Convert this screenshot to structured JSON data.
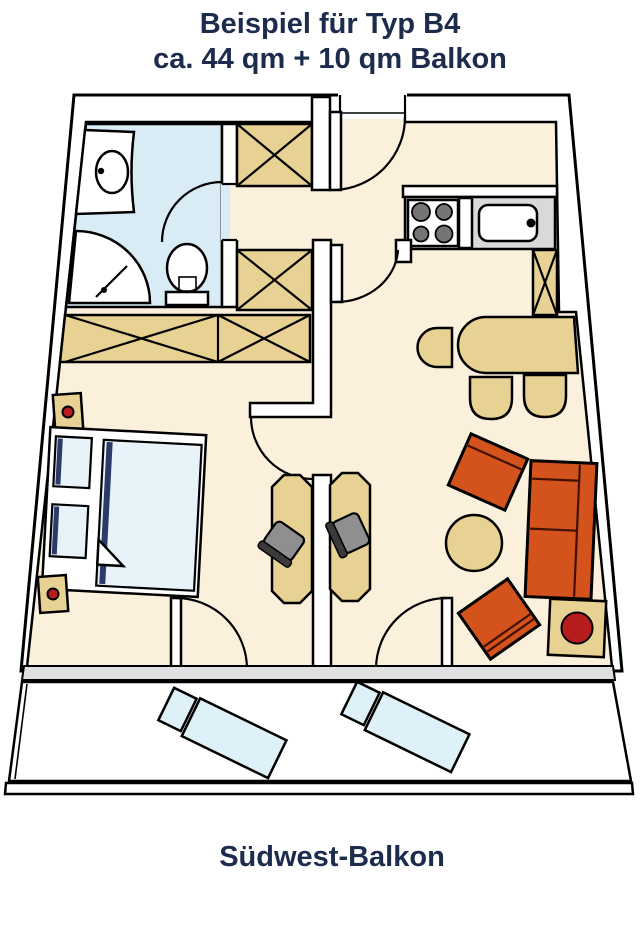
{
  "title": {
    "line1": "Beispiel für Typ B4",
    "line2": "ca. 44 qm + 10 qm Balkon"
  },
  "footer": {
    "balcony_label": "Südwest-Balkon"
  },
  "colors": {
    "background": "#ffffff",
    "wall": "#ffffff",
    "outline": "#000000",
    "floor": "#fbf0dc",
    "bathroom_floor": "#d9ecf5",
    "wood": "#e7d193",
    "orange": "#d4521c",
    "seam": "#401000",
    "lamp_red": "#b81d1d",
    "counter_gray": "#d9d9d9",
    "burner_gray": "#757575",
    "chair_gray": "#8f8f8f",
    "chair_back": "#3a3a3a",
    "textile_blue": "#e7f3f9",
    "lounger_blue": "#def0f8",
    "navy_stripe": "#2b3a66",
    "window_gray": "#e0e0e0",
    "text_navy": "#1d2b4d"
  }
}
